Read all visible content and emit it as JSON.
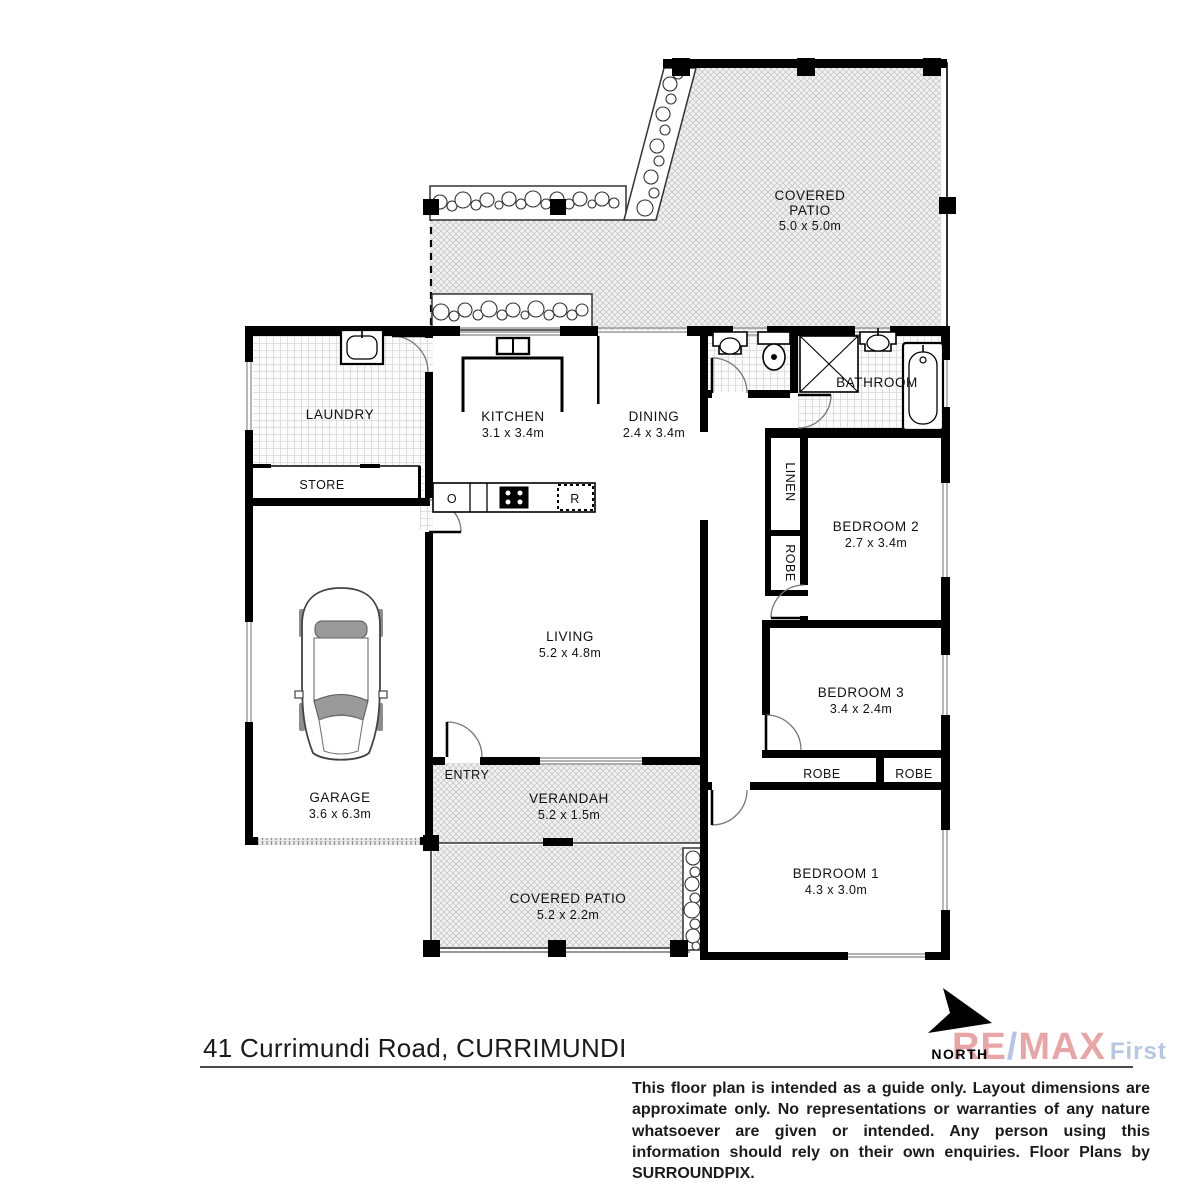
{
  "rooms": {
    "covered_patio_top": {
      "line1": "COVERED",
      "line2": "PATIO",
      "dims": "5.0 x 5.0m"
    },
    "laundry": {
      "name": "LAUNDRY"
    },
    "store": {
      "name": "STORE"
    },
    "kitchen": {
      "name": "KITCHEN",
      "dims": "3.1 x 3.4m"
    },
    "dining": {
      "name": "DINING",
      "dims": "2.4 x 3.4m"
    },
    "bathroom": {
      "name": "BATHROOM"
    },
    "linen": {
      "name": "LINEN"
    },
    "robe_hall": {
      "name": "ROBE"
    },
    "bedroom2": {
      "name": "BEDROOM 2",
      "dims": "2.7 x 3.4m"
    },
    "living": {
      "name": "LIVING",
      "dims": "5.2 x 4.8m"
    },
    "bedroom3": {
      "name": "BEDROOM 3",
      "dims": "3.4 x 2.4m"
    },
    "robe_b3_left": {
      "name": "ROBE"
    },
    "robe_b3_right": {
      "name": "ROBE"
    },
    "garage": {
      "name": "GARAGE",
      "dims": "3.6 x 6.3m"
    },
    "entry": {
      "name": "ENTRY"
    },
    "verandah": {
      "name": "VERANDAH",
      "dims": "5.2 x 1.5m"
    },
    "covered_patio_bottom": {
      "name": "COVERED PATIO",
      "dims": "5.2 x 2.2m"
    },
    "bedroom1": {
      "name": "BEDROOM 1",
      "dims": "4.3 x 3.0m"
    }
  },
  "appliances": {
    "oven": "O",
    "fridge": "R"
  },
  "footer": {
    "address": "41 Currimundi Road, CURRIMUNDI",
    "north_label": "NORTH",
    "logo": {
      "re": "RE",
      "slash": "/",
      "max": "MAX",
      "suffix": "First"
    },
    "disclaimer": "This floor plan is intended as a guide only. Layout dimensions are approximate only. No representations or warranties of any nature whatsoever are given or intended. Any person using this information should rely on their own enquiries. Floor Plans by  SURROUNDPIX."
  },
  "colors": {
    "walls": "#000000",
    "remax_red": "#dd6f6f",
    "remax_blue": "#8f9fdd",
    "first_blue": "#8ba6cf"
  }
}
